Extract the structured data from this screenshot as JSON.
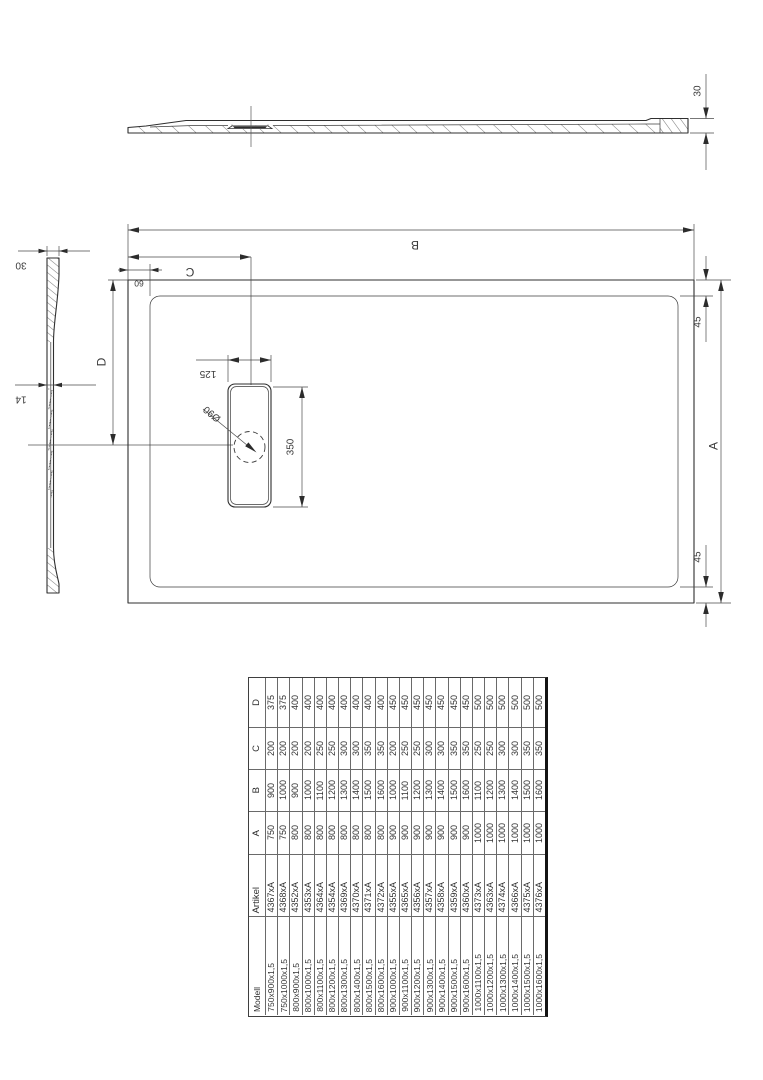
{
  "drawing": {
    "title": "shower-tray-technical-drawing",
    "dimensions": {
      "profile_height": "30",
      "section_rim_height": "30",
      "section_floor_thickness": "14",
      "plan_length": "B",
      "drain_offset_length": "C",
      "drain_center_from_top": "D",
      "plan_width": "A",
      "rim_inset_top": "45",
      "rim_inset_bottom": "45",
      "rim_inset_left": "60",
      "drain_cover_width": "125",
      "drain_cover_length": "350",
      "drain_hole_diameter": "Ø90"
    }
  },
  "table": {
    "column_headers": {
      "modell": "Modell",
      "artikel": "Artikel",
      "a": "A",
      "b": "B",
      "c": "C",
      "d": "D"
    },
    "rows": [
      {
        "modell": "750x900x1,5",
        "artikel": "4367xA",
        "a": "750",
        "b": "900",
        "c": "200",
        "d": "375"
      },
      {
        "modell": "750x1000x1,5",
        "artikel": "4368xA",
        "a": "750",
        "b": "1000",
        "c": "200",
        "d": "375"
      },
      {
        "modell": "800x900x1,5",
        "artikel": "4352xA",
        "a": "800",
        "b": "900",
        "c": "200",
        "d": "400"
      },
      {
        "modell": "800x1000x1,5",
        "artikel": "4353xA",
        "a": "800",
        "b": "1000",
        "c": "200",
        "d": "400"
      },
      {
        "modell": "800x1100x1,5",
        "artikel": "4364xA",
        "a": "800",
        "b": "1100",
        "c": "250",
        "d": "400"
      },
      {
        "modell": "800x1200x1,5",
        "artikel": "4354xA",
        "a": "800",
        "b": "1200",
        "c": "250",
        "d": "400"
      },
      {
        "modell": "800x1300x1,5",
        "artikel": "4369xA",
        "a": "800",
        "b": "1300",
        "c": "300",
        "d": "400"
      },
      {
        "modell": "800x1400x1,5",
        "artikel": "4370xA",
        "a": "800",
        "b": "1400",
        "c": "300",
        "d": "400"
      },
      {
        "modell": "800x1500x1,5",
        "artikel": "4371xA",
        "a": "800",
        "b": "1500",
        "c": "350",
        "d": "400"
      },
      {
        "modell": "800x1600x1,5",
        "artikel": "4372xA",
        "a": "800",
        "b": "1600",
        "c": "350",
        "d": "400"
      },
      {
        "modell": "900x1000x1,5",
        "artikel": "4355xA",
        "a": "900",
        "b": "1000",
        "c": "200",
        "d": "450"
      },
      {
        "modell": "900x1100x1,5",
        "artikel": "4365xA",
        "a": "900",
        "b": "1100",
        "c": "250",
        "d": "450"
      },
      {
        "modell": "900x1200x1,5",
        "artikel": "4356xA",
        "a": "900",
        "b": "1200",
        "c": "250",
        "d": "450"
      },
      {
        "modell": "900x1300x1,5",
        "artikel": "4357xA",
        "a": "900",
        "b": "1300",
        "c": "300",
        "d": "450"
      },
      {
        "modell": "900x1400x1,5",
        "artikel": "4358xA",
        "a": "900",
        "b": "1400",
        "c": "300",
        "d": "450"
      },
      {
        "modell": "900x1500x1,5",
        "artikel": "4359xA",
        "a": "900",
        "b": "1500",
        "c": "350",
        "d": "450"
      },
      {
        "modell": "900x1600x1,5",
        "artikel": "4360xA",
        "a": "900",
        "b": "1600",
        "c": "350",
        "d": "450"
      },
      {
        "modell": "1000x1100x1,5",
        "artikel": "4373xA",
        "a": "1000",
        "b": "1100",
        "c": "250",
        "d": "500"
      },
      {
        "modell": "1000x1200x1,5",
        "artikel": "4363xA",
        "a": "1000",
        "b": "1200",
        "c": "250",
        "d": "500"
      },
      {
        "modell": "1000x1300x1,5",
        "artikel": "4374xA",
        "a": "1000",
        "b": "1300",
        "c": "300",
        "d": "500"
      },
      {
        "modell": "1000x1400x1,5",
        "artikel": "4366xA",
        "a": "1000",
        "b": "1400",
        "c": "300",
        "d": "500"
      },
      {
        "modell": "1000x1500x1,5",
        "artikel": "4375xA",
        "a": "1000",
        "b": "1500",
        "c": "350",
        "d": "500"
      },
      {
        "modell": "1000x1600x1,5",
        "artikel": "4376xA",
        "a": "1000",
        "b": "1600",
        "c": "350",
        "d": "500"
      }
    ]
  }
}
